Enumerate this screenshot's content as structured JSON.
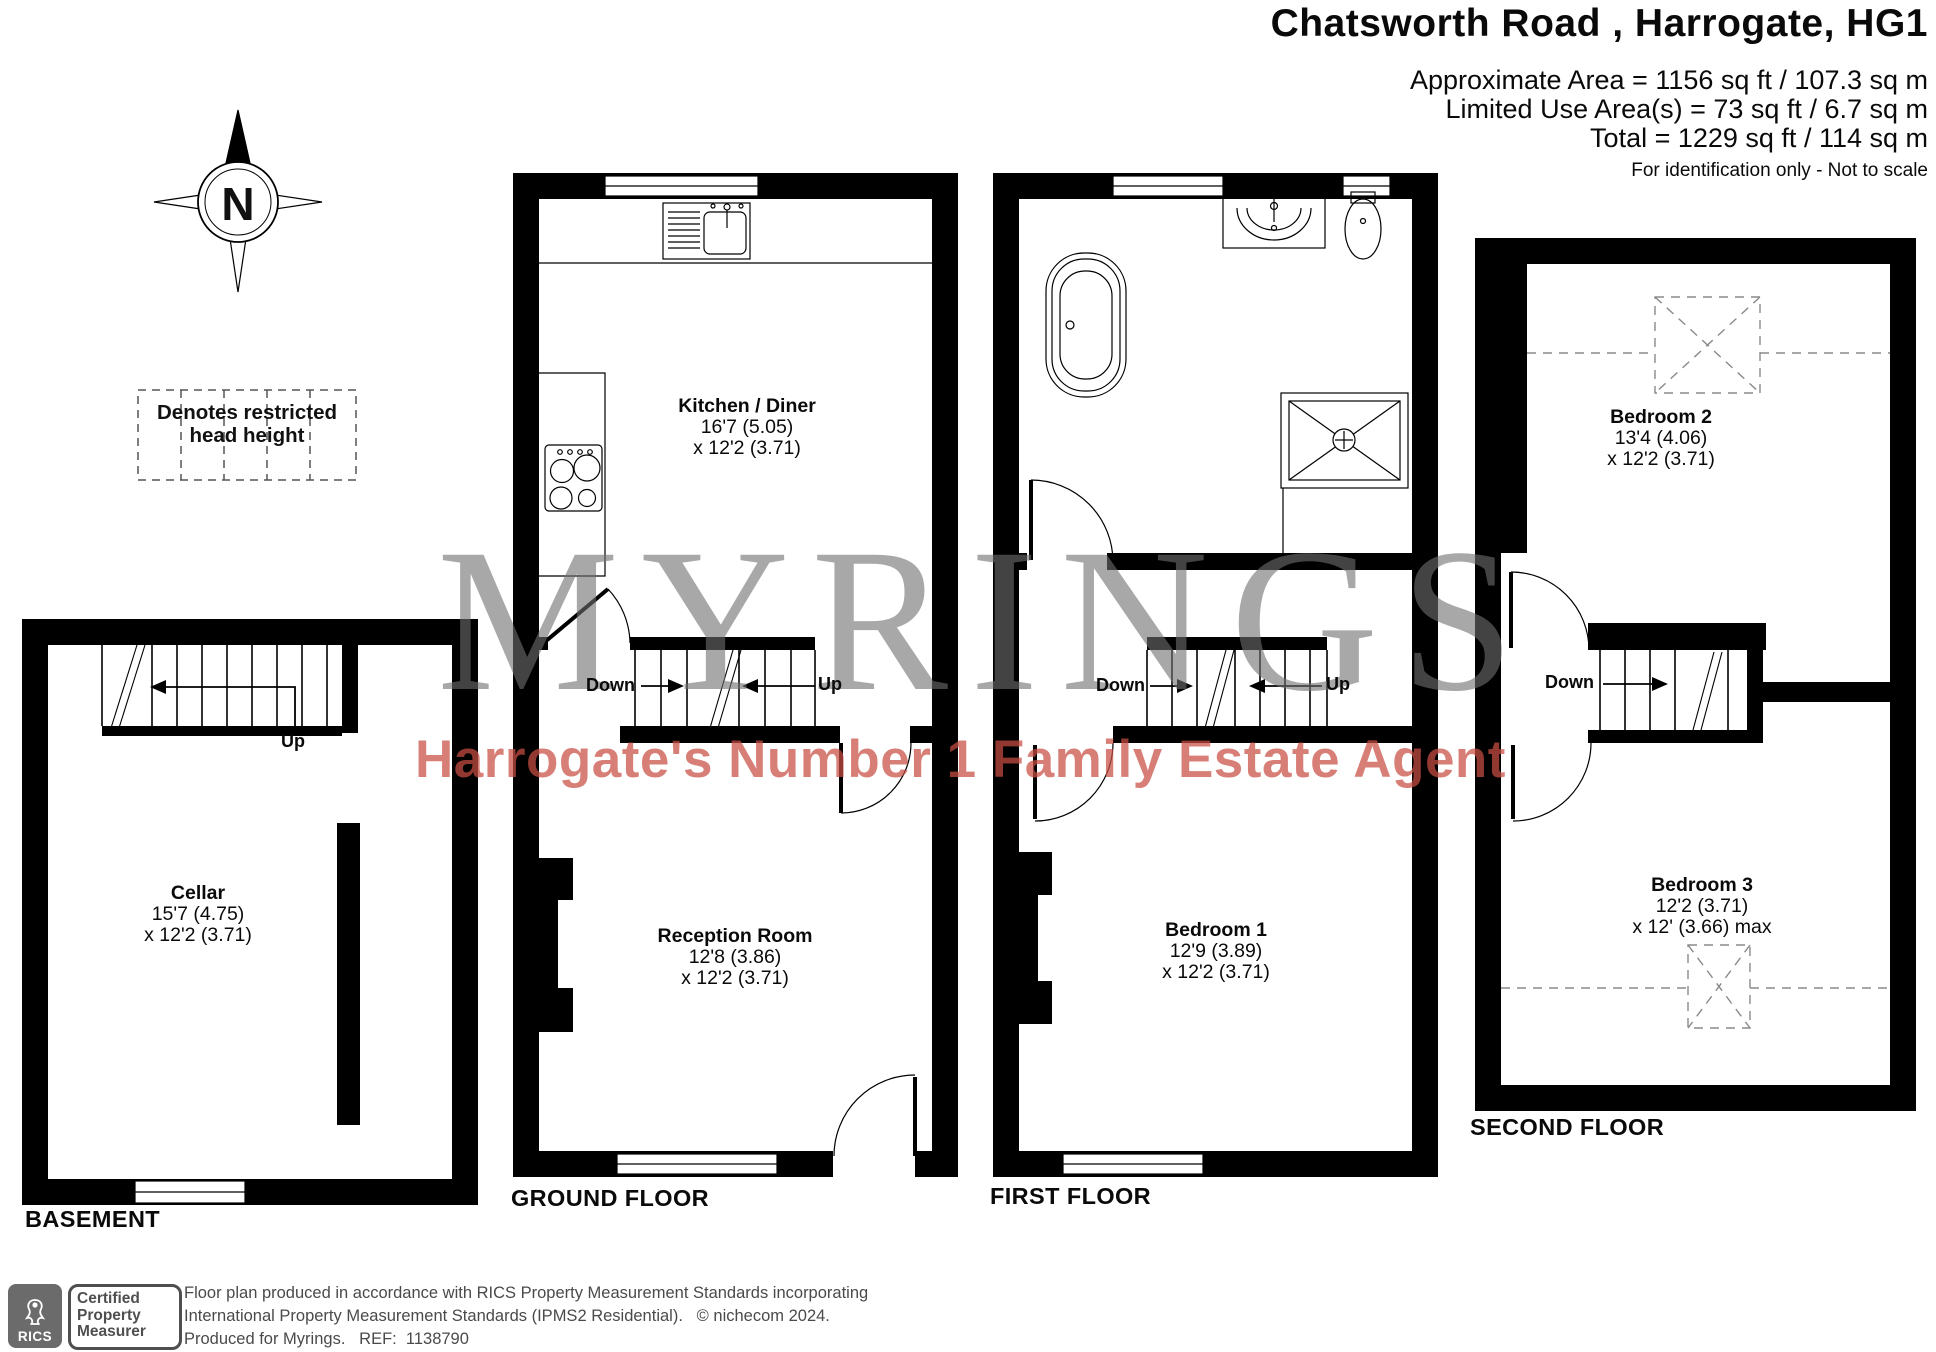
{
  "header": {
    "title": "Chatsworth Road , Harrogate, HG1",
    "area_line_1": "Approximate Area = 1156 sq ft / 107.3 sq m",
    "area_line_2": "Limited Use Area(s) = 73 sq ft / 6.7 sq m",
    "area_line_3": "Total = 1229 sq ft / 114 sq m",
    "disclaimer": "For identification only - Not to scale"
  },
  "legend": {
    "restricted_head_height": "Denotes restricted head height"
  },
  "compass": {
    "north_label": "N"
  },
  "floors": {
    "basement": {
      "label": "BASEMENT",
      "room": {
        "name": "Cellar",
        "dim_a": "15'7 (4.75)",
        "dim_b": "x 12'2 (3.71)"
      },
      "stair_up_label": "Up"
    },
    "ground": {
      "label": "GROUND FLOOR",
      "kitchen": {
        "name": "Kitchen / Diner",
        "dim_a": "16'7 (5.05)",
        "dim_b": "x 12'2 (3.71)"
      },
      "reception": {
        "name": "Reception Room",
        "dim_a": "12'8 (3.86)",
        "dim_b": "x 12'2 (3.71)"
      },
      "stair_down_label": "Down",
      "stair_up_label": "Up"
    },
    "first": {
      "label": "FIRST FLOOR",
      "bedroom1": {
        "name": "Bedroom 1",
        "dim_a": "12'9 (3.89)",
        "dim_b": "x 12'2 (3.71)"
      },
      "stair_down_label": "Down",
      "stair_up_label": "Up"
    },
    "second": {
      "label": "SECOND FLOOR",
      "bedroom2": {
        "name": "Bedroom 2",
        "dim_a": "13'4 (4.06)",
        "dim_b": "x 12'2 (3.71)"
      },
      "bedroom3": {
        "name": "Bedroom 3",
        "dim_a": "12'2 (3.71)",
        "dim_b": "x 12' (3.66) max"
      },
      "stair_down_label": "Down"
    }
  },
  "watermark": {
    "brand": "MYRINGS",
    "tagline": "Harrogate's Number 1 Family Estate Agent"
  },
  "footer": {
    "rics_label": "RICS",
    "certified_label": "Certified Property Measurer",
    "line_1": "Floor plan produced in accordance with RICS Property Measurement Standards incorporating",
    "line_2": "International Property Measurement Standards (IPMS2 Residential).   © nichecom 2024.",
    "line_3": "Produced for Myrings.   REF:  1138790"
  },
  "colors": {
    "wall": "#000000",
    "watermark_gray": "#707070",
    "watermark_red": "#c94f44",
    "footer_gray": "#4a4a4a",
    "rics_badge": "#6b6b6b"
  }
}
